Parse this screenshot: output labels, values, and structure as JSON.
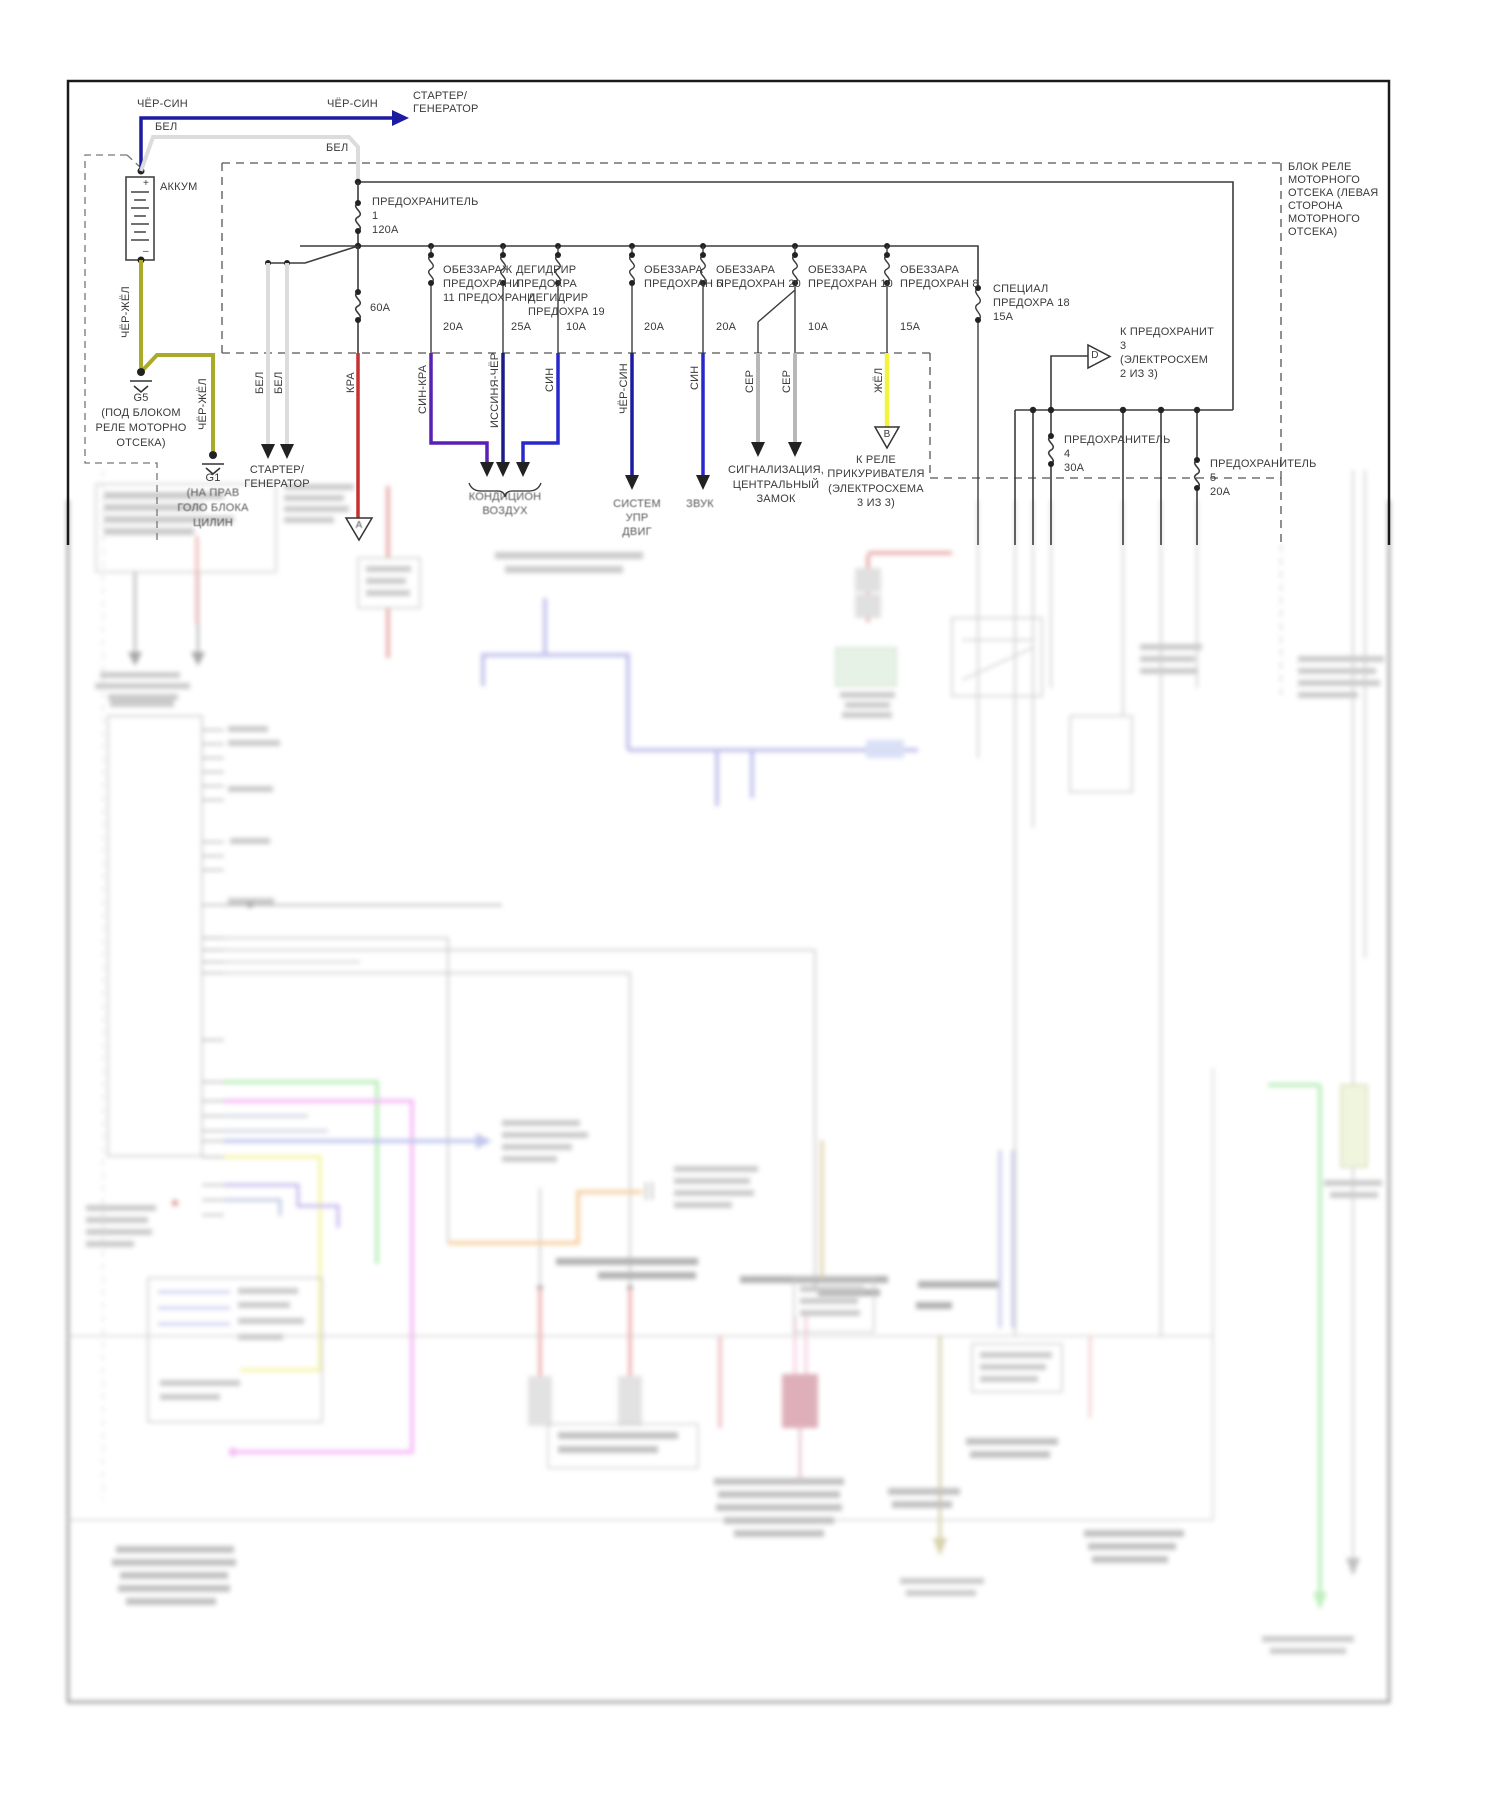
{
  "diagram": {
    "top_left": {
      "wire_cher_sin_a": "ЧЁР-СИН",
      "wire_cher_sin_b": "ЧЁР-СИН",
      "starter_top_1": "СТАРТЕР/",
      "starter_top_2": "ГЕНЕРАТОР",
      "wire_bel_a": "БЕЛ",
      "wire_bel_b": "БЕЛ",
      "battery_label": "АККУМ",
      "battery_plus": "+",
      "battery_minus": "–",
      "wire_cher_zhel_a": "ЧЁР-ЖЁЛ",
      "wire_cher_zhel_b": "ЧЁР-ЖЁЛ",
      "g5": "G5",
      "g5_note_1": "(ПОД БЛОКОМ",
      "g5_note_2": "РЕЛЕ МОТОРНО",
      "g5_note_3": "ОТСЕКА)",
      "g1": "G1",
      "g1_note_1": "(НА ПРАВ",
      "g1_note_2": "ГОЛО БЛОКА",
      "g1_note_3": "ЦИЛИН"
    },
    "fuse_block": {
      "box_label_1": "БЛОК РЕЛЕ",
      "box_label_2": "МОТОРНОГО",
      "box_label_3": "ОТСЕКА (ЛЕВАЯ",
      "box_label_4": "СТОРОНА",
      "box_label_5": "МОТОРНОГО",
      "box_label_6": "ОТСЕКА)",
      "fuse1_1": "ПРЕДОХРАНИТЕЛЬ",
      "fuse1_2": "1",
      "fuse1_3": "120А",
      "fuse60_amp": "60А",
      "f11_1": "ОБЕЗЗАРАЖ",
      "f11_2": "ПРЕДОХРАНИ",
      "f11_3": "11 ПРЕДОХРАНИ",
      "f11_amp": "20А",
      "f12_1": "ДЕГИДРИР",
      "f12_2": "ПРЕДОХРА",
      "f12_amp": "25А",
      "f19_1": "ДЕГИДРИР",
      "f19_2": "ПРЕДОХРА 19",
      "f19_amp": "10А",
      "f6_1": "ОБЕЗЗАРА",
      "f6_2": "ПРЕДОХРАН 6",
      "f6_amp": "20А",
      "f20_1": "ОБЕЗЗАРА",
      "f20_2": "ПРЕДОХРАН 20",
      "f20_amp": "20А",
      "f10_1": "ОБЕЗЗАРА",
      "f10_2": "ПРЕДОХРАН 10",
      "f10_amp": "10А",
      "f8_1": "ОБЕЗЗАРА",
      "f8_2": "ПРЕДОХРАН 8",
      "f8_amp": "15А",
      "f18_1": "СПЕЦИАЛ",
      "f18_2": "ПРЕДОХРА 18",
      "f18_amp": "15А",
      "fuse4_1": "ПРЕДОХРАНИТЕЛЬ",
      "fuse4_2": "4",
      "fuse4_3": "30А",
      "fuse5_1": "ПРЕДОХРАНИТЕЛЬ",
      "fuse5_2": "5",
      "fuse5_3": "20А"
    },
    "wire_labels": {
      "bel_c": "БЕЛ",
      "bel_d": "БЕЛ",
      "kra": "КРА",
      "sin_kra": "СИН-КРА",
      "issinya_cher": "ИССИНЯ-ЧЁР",
      "sin_a": "СИН",
      "cher_sin_c": "ЧЁР-СИН",
      "sin_b": "СИН",
      "ser_a": "СЕР",
      "ser_b": "СЕР",
      "zhel": "ЖЁЛ"
    },
    "outputs": {
      "starter_bot_1": "СТАРТЕР/",
      "starter_bot_2": "ГЕНЕРАТОР",
      "kond_1": "КОНДИЦИОН",
      "kond_2": "ВОЗДУХ",
      "sistem_1": "СИСТЕМ",
      "sistem_2": "УПР",
      "sistem_3": "ДВИГ",
      "zvuk": "ЗВУК",
      "sig_1": "СИГНАЛИЗАЦИЯ,",
      "sig_2": "ЦЕНТРАЛЬНЫЙ",
      "sig_3": "ЗАМОК",
      "rele_1": "К РЕЛЕ",
      "rele_2": "ПРИКУРИВАТЕЛЯ",
      "rele_3": "(ЭЛЕКТРОСХЕМА",
      "rele_4": "3 ИЗ 3)",
      "kpred_1": "К ПРЕДОХРАНИТ",
      "kpred_2": "3",
      "kpred_3": "(ЭЛЕКТРОСХЕМ",
      "kpred_4": "2 ИЗ 3)",
      "tri_a": "А",
      "tri_b": "В",
      "tri_d": "D"
    },
    "colors": {
      "line": "#3c3c3c",
      "navy": "#1c1ca0",
      "blue": "#2828cc",
      "purple": "#5a1fb5",
      "red": "#c63030",
      "yellow": "#f2f240",
      "olive": "#a8aa28",
      "white_wire": "#dcdcdc",
      "gray_wire": "#b8b8b8"
    }
  }
}
